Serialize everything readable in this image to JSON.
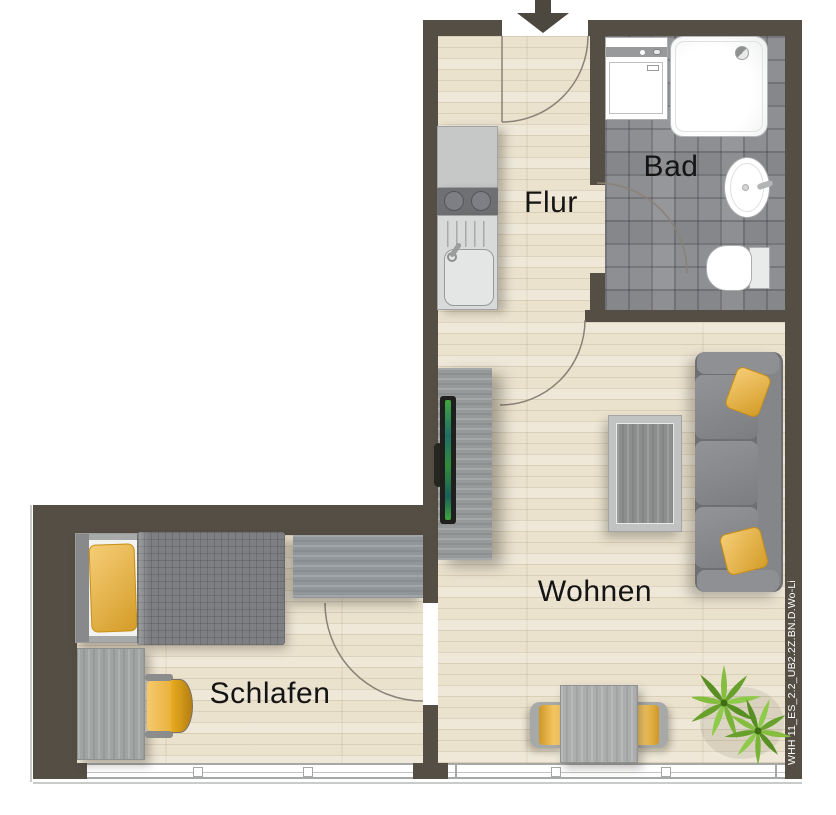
{
  "plan": {
    "title_code": "WHH 11_ES_2.2_UB2.2Z.BN.D.Wo-Li",
    "rooms": [
      {
        "id": "flur",
        "label": "Flur"
      },
      {
        "id": "bad",
        "label": "Bad"
      },
      {
        "id": "wohnen",
        "label": "Wohnen"
      },
      {
        "id": "schlafen",
        "label": "Schlafen"
      }
    ],
    "entrance_icon": "down-arrow",
    "fixtures": {
      "bad": [
        "washing-machine",
        "shower",
        "washbasin",
        "toilet"
      ],
      "kitchen": [
        "counter",
        "stove-two-burners",
        "kitchen-sink"
      ],
      "wohnen": [
        "tv-sideboard",
        "tv-screen",
        "sofa",
        "coffee-table",
        "dining-table",
        "two-chairs",
        "plant"
      ],
      "schlafen": [
        "bed",
        "wardrobe-sideboard",
        "desk",
        "desk-chair"
      ]
    }
  },
  "colors": {
    "wall": "#554E45",
    "wood-floor": "#EBE2CE",
    "tile-floor": "#8E8F93",
    "accent-yellow": "#F1B22D",
    "furniture-gray": "#96999A",
    "plant-green": "#7FB83D",
    "label-text": "#141414",
    "code-text": "#FFFFFF",
    "door-arc": "#8A8177",
    "fixture-white": "#FFFFFF"
  }
}
